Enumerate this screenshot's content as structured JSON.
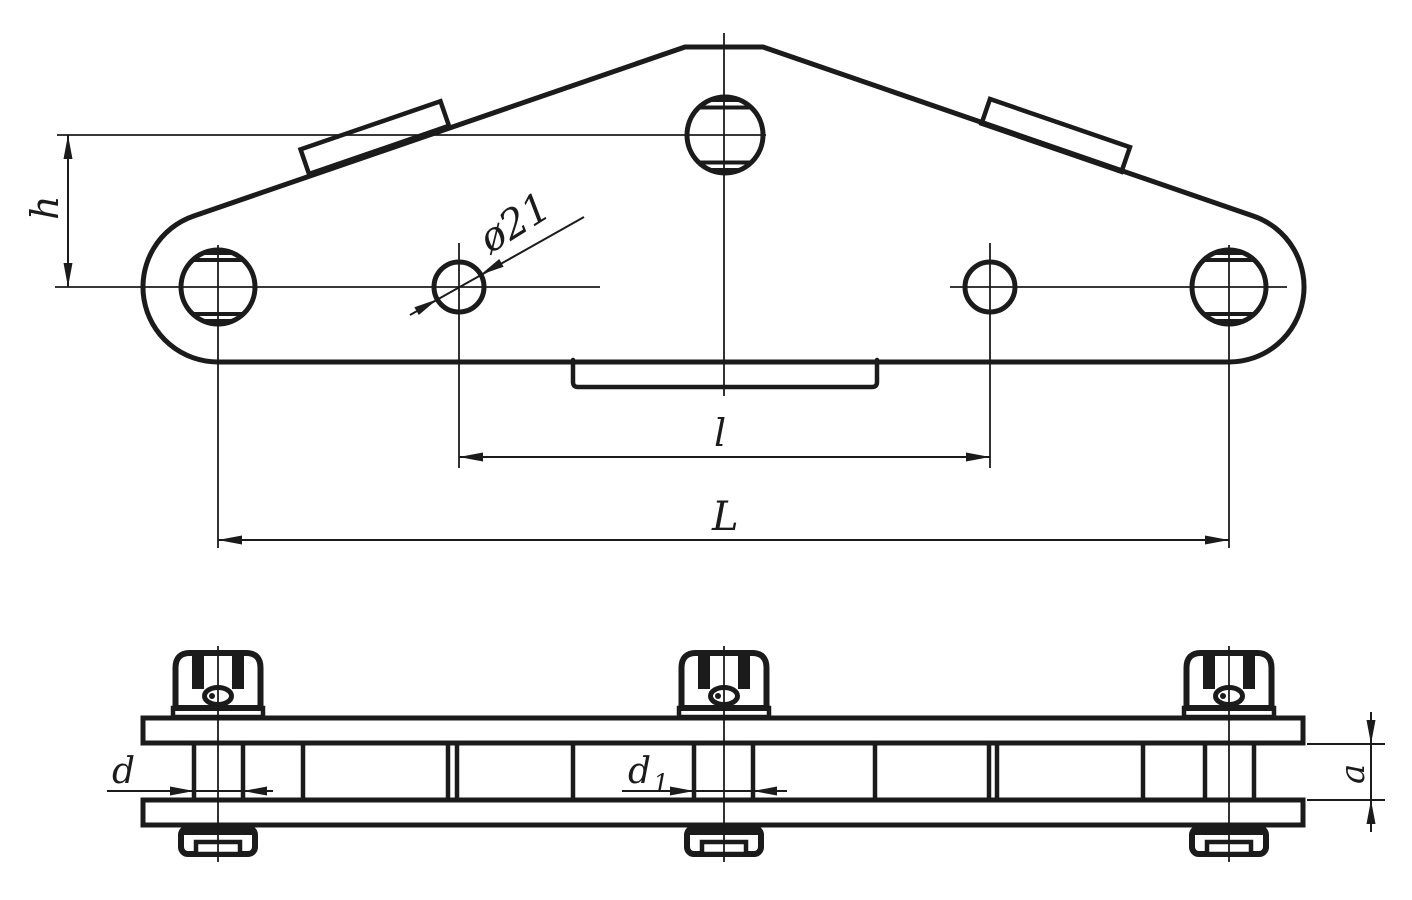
{
  "labels": {
    "height": "h",
    "diameter": "ø21",
    "inner_span": "l",
    "overall_span": "L",
    "pin_d": "d",
    "pin_d1_base": "d",
    "pin_d1_sub": "1",
    "plate_gap": "a"
  },
  "colors": {
    "ink": "#1b1b1b",
    "paper": "#ffffff"
  }
}
